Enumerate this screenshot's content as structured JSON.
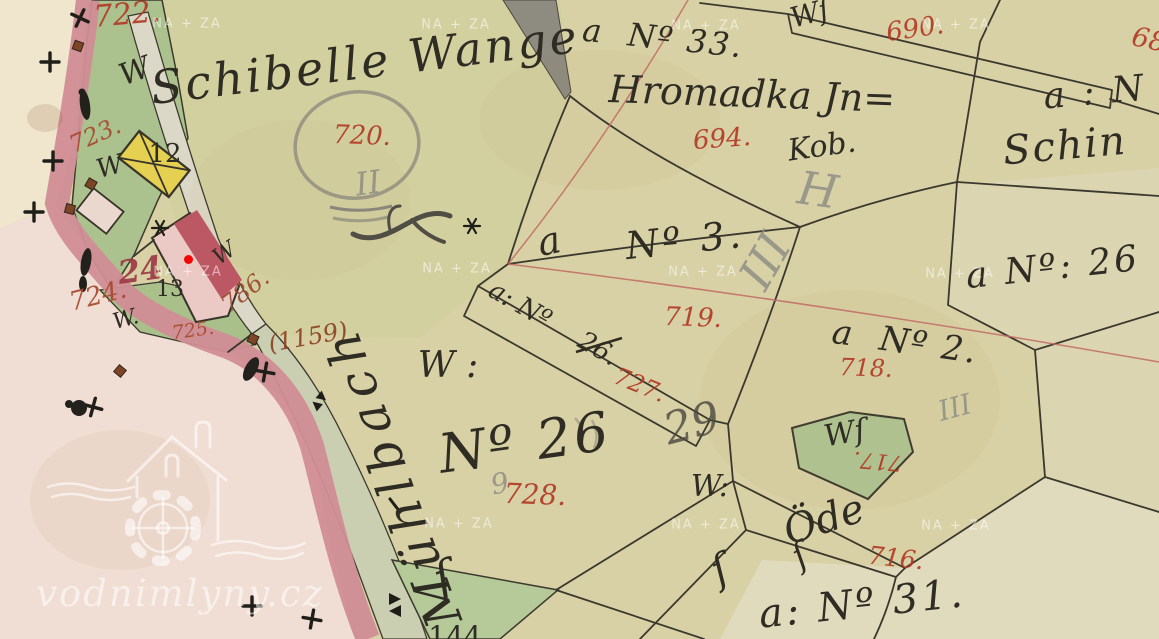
{
  "site": {
    "logo_text": "vodnimlyny.cz",
    "watermark_text": "NA + ZA"
  },
  "marker": {
    "x": 188,
    "y": 259,
    "color": "#f50505"
  },
  "palette": {
    "paper": "#d8d1a5",
    "field": "#d3d0a0",
    "pale_cream": "#efe6cd",
    "pale_pink": "#f0ddd3",
    "rose_road": "#d08d95",
    "garden_green": "#abc28e",
    "path_fill": "#dcd8c7",
    "stream_fill": "#c9cfb0",
    "yellow_building": "#e5d052",
    "pink_building": "#ebc9c4",
    "carmine_building": "#bc5864",
    "ink": "#2e2c23",
    "red_number": "#b23a26",
    "brown_number": "#9a4a2e",
    "pencil": "#8b8b83",
    "survey_line": "#c26a64",
    "watermark": "rgba(255,255,255,0.55)"
  },
  "watermarks": [
    {
      "x": 187,
      "y": 24
    },
    {
      "x": 456,
      "y": 25
    },
    {
      "x": 706,
      "y": 26
    },
    {
      "x": 956,
      "y": 25
    },
    {
      "x": 188,
      "y": 272
    },
    {
      "x": 457,
      "y": 269
    },
    {
      "x": 703,
      "y": 272
    },
    {
      "x": 960,
      "y": 274
    },
    {
      "x": 459,
      "y": 524
    },
    {
      "x": 706,
      "y": 525
    },
    {
      "x": 956,
      "y": 526
    }
  ],
  "labels": [
    {
      "name": "parcel-number-722",
      "text": "722.",
      "x": 127,
      "y": 15,
      "size": 30,
      "rot": -5,
      "cls": "num"
    },
    {
      "name": "parcel-number-723",
      "text": "723.",
      "x": 95,
      "y": 135,
      "size": 24,
      "rot": -24,
      "cls": "num",
      "color": "#a8492f"
    },
    {
      "name": "parcel-number-720",
      "text": "720.",
      "x": 362,
      "y": 136,
      "size": 26,
      "rot": 2,
      "cls": "num"
    },
    {
      "name": "parcel-number-694",
      "text": "694.",
      "x": 722,
      "y": 139,
      "size": 26,
      "rot": -4,
      "cls": "num"
    },
    {
      "name": "parcel-number-690",
      "text": "690.",
      "x": 915,
      "y": 29,
      "size": 26,
      "rot": -8,
      "cls": "num"
    },
    {
      "name": "parcel-number-68-clipped",
      "text": "68",
      "x": 1149,
      "y": 40,
      "size": 27,
      "rot": 12,
      "cls": "num"
    },
    {
      "name": "parcel-number-719",
      "text": "719.",
      "x": 693,
      "y": 318,
      "size": 26,
      "rot": 2,
      "cls": "num"
    },
    {
      "name": "parcel-number-727",
      "text": "727.",
      "x": 640,
      "y": 385,
      "size": 24,
      "rot": 22,
      "cls": "num"
    },
    {
      "name": "parcel-number-718",
      "text": "718.",
      "x": 866,
      "y": 368,
      "size": 24,
      "rot": 2,
      "cls": "num"
    },
    {
      "name": "parcel-number-717",
      "text": "717.",
      "x": 878,
      "y": 460,
      "size": 22,
      "rot": 185,
      "cls": "num"
    },
    {
      "name": "parcel-number-728",
      "text": "728.",
      "x": 535,
      "y": 495,
      "size": 28,
      "rot": 2,
      "cls": "num"
    },
    {
      "name": "parcel-number-716",
      "text": "716.",
      "x": 896,
      "y": 558,
      "size": 25,
      "rot": 6,
      "cls": "num"
    },
    {
      "name": "parcel-number-724",
      "text": "724.",
      "x": 98,
      "y": 296,
      "size": 26,
      "rot": -14,
      "cls": "num",
      "color": "#a8492f"
    },
    {
      "name": "parcel-number-725",
      "text": "725.",
      "x": 193,
      "y": 331,
      "size": 19,
      "rot": -8,
      "cls": "num",
      "color": "#a8492f"
    },
    {
      "name": "house-number-24",
      "text": "24",
      "x": 140,
      "y": 270,
      "size": 32,
      "rot": -8,
      "cls": "num",
      "color": "#9c3a44",
      "w": 700
    },
    {
      "name": "parcel-number-786",
      "text": "786.",
      "x": 245,
      "y": 291,
      "size": 24,
      "rot": -38,
      "cls": "num",
      "color": "#9a4a2e"
    },
    {
      "name": "parcel-number-1159",
      "text": "(1159)",
      "x": 308,
      "y": 337,
      "size": 24,
      "rot": -10,
      "cls": "num",
      "color": "#8d4226"
    },
    {
      "name": "field-name-schibelle-wange",
      "text": "Schibelle Wange",
      "x": 365,
      "y": 62,
      "size": 46,
      "rot": -7,
      "cls": "script",
      "ls": 3
    },
    {
      "name": "letter-a-n3",
      "text": "a",
      "x": 549,
      "y": 241,
      "size": 38,
      "rot": -12,
      "cls": "script"
    },
    {
      "name": "parcel-ref-n3",
      "text": "Nº 3.",
      "x": 685,
      "y": 240,
      "size": 38,
      "rot": -6,
      "cls": "script",
      "ls": 4
    },
    {
      "name": "parcel-ref-n33",
      "text": "a  Nº 33.",
      "x": 663,
      "y": 38,
      "size": 32,
      "rot": 6,
      "cls": "script",
      "ls": 2
    },
    {
      "name": "owner-hromadka",
      "text": "Hromadka Jn=",
      "x": 752,
      "y": 94,
      "size": 38,
      "rot": 2,
      "cls": "script"
    },
    {
      "name": "owner-kob",
      "text": "Kob.",
      "x": 822,
      "y": 147,
      "size": 30,
      "rot": -8,
      "cls": "script"
    },
    {
      "name": "parcel-ref-a-n-right",
      "text": "a : N",
      "x": 1095,
      "y": 93,
      "size": 36,
      "rot": -5,
      "cls": "script",
      "ls": 3
    },
    {
      "name": "owner-schin",
      "text": "Schin",
      "x": 1065,
      "y": 146,
      "size": 40,
      "rot": -5,
      "cls": "script",
      "ls": 2
    },
    {
      "name": "w-abbrev-strip-690",
      "text": "Wſ",
      "x": 810,
      "y": 14,
      "size": 28,
      "rot": -15,
      "cls": "script"
    },
    {
      "name": "w-abbrev-1",
      "text": "W",
      "x": 135,
      "y": 72,
      "size": 30,
      "rot": -20,
      "cls": "script"
    },
    {
      "name": "w-abbrev-2",
      "text": "W",
      "x": 110,
      "y": 167,
      "size": 26,
      "rot": -15,
      "cls": "script"
    },
    {
      "name": "w-abbrev-3",
      "text": "W.",
      "x": 126,
      "y": 320,
      "size": 22,
      "rot": -15,
      "cls": "script"
    },
    {
      "name": "w-abbrev-4",
      "text": "W",
      "x": 225,
      "y": 254,
      "size": 22,
      "rot": -35,
      "cls": "script"
    },
    {
      "name": "w-abbrev-5",
      "text": "W :",
      "x": 448,
      "y": 366,
      "size": 36,
      "rot": 0,
      "cls": "script"
    },
    {
      "name": "w-abbrev-6",
      "text": "W:",
      "x": 710,
      "y": 487,
      "size": 30,
      "rot": 0,
      "cls": "script"
    },
    {
      "name": "w-abbrev-717",
      "text": "Wſ",
      "x": 845,
      "y": 434,
      "size": 30,
      "rot": -10,
      "cls": "script"
    },
    {
      "name": "strip-ref-a-n",
      "text": "a: Nº",
      "x": 520,
      "y": 305,
      "size": 26,
      "rot": 30,
      "cls": "script"
    },
    {
      "name": "crossed-out-26",
      "text": "26.",
      "x": 598,
      "y": 349,
      "size": 26,
      "rot": 30,
      "cls": "script"
    },
    {
      "name": "parcel-ref-n2",
      "text": "a  Nº 2.",
      "x": 905,
      "y": 342,
      "size": 34,
      "rot": 8,
      "cls": "script",
      "ls": 2
    },
    {
      "name": "parcel-ref-n26-right",
      "text": "a Nº: 26",
      "x": 1053,
      "y": 268,
      "size": 36,
      "rot": -6,
      "cls": "script",
      "ls": 3
    },
    {
      "name": "parcel-ref-n26-large",
      "text": "Nº 26",
      "x": 525,
      "y": 443,
      "size": 54,
      "rot": -8,
      "cls": "script",
      "ls": 3
    },
    {
      "name": "oede-label",
      "text": "Öde",
      "x": 824,
      "y": 520,
      "size": 40,
      "rot": -18,
      "cls": "script"
    },
    {
      "name": "parcel-ref-n31",
      "text": "a: Nº 31.",
      "x": 862,
      "y": 604,
      "size": 40,
      "rot": -6,
      "cls": "script",
      "ls": 3
    },
    {
      "name": "building-number-12",
      "text": "12",
      "x": 165,
      "y": 154,
      "size": 26,
      "rot": 0,
      "cls": "plain"
    },
    {
      "name": "building-number-13",
      "text": "13",
      "x": 170,
      "y": 290,
      "size": 22,
      "rot": 0,
      "cls": "plain"
    },
    {
      "name": "stream-name-muehlbach",
      "text": "Mühlbach",
      "x": 392,
      "y": 476,
      "size": 50,
      "rot": -110,
      "cls": "script",
      "ls": 8
    },
    {
      "name": "clipped-number-144",
      "text": "144",
      "x": 455,
      "y": 637,
      "size": 28,
      "rot": 0,
      "cls": "plain"
    },
    {
      "name": "flourish-1",
      "text": "ſ",
      "x": 443,
      "y": 578,
      "size": 46,
      "rot": -20,
      "cls": "script"
    },
    {
      "name": "flourish-2",
      "text": "ſ",
      "x": 720,
      "y": 570,
      "size": 40,
      "rot": -25,
      "cls": "script"
    },
    {
      "name": "flourish-3",
      "text": "ſ",
      "x": 800,
      "y": 556,
      "size": 34,
      "rot": -30,
      "cls": "script"
    },
    {
      "name": "pencil-ii",
      "text": "II",
      "x": 368,
      "y": 183,
      "size": 32,
      "rot": -8,
      "cls": "pencil"
    },
    {
      "name": "pencil-iii-1",
      "text": "III",
      "x": 765,
      "y": 261,
      "size": 46,
      "rot": -60,
      "cls": "pencil"
    },
    {
      "name": "pencil-h",
      "text": "H",
      "x": 818,
      "y": 190,
      "size": 46,
      "rot": 8,
      "cls": "pencil"
    },
    {
      "name": "pencil-29",
      "text": "29",
      "x": 692,
      "y": 424,
      "size": 44,
      "rot": -15,
      "cls": "pencil",
      "color": "#4a4840"
    },
    {
      "name": "pencil-iii-2",
      "text": "III",
      "x": 955,
      "y": 408,
      "size": 28,
      "rot": -15,
      "cls": "pencil"
    },
    {
      "name": "pencil-9",
      "text": "9",
      "x": 500,
      "y": 484,
      "size": 28,
      "rot": -12,
      "cls": "pencil"
    }
  ]
}
